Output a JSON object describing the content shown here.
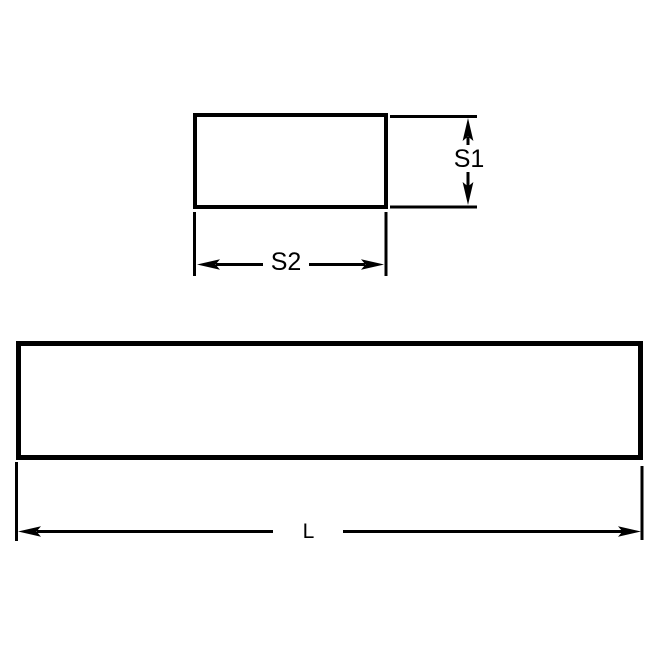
{
  "drawing": {
    "background_color": "#ffffff",
    "line_color": "#000000",
    "labels": {
      "s1": "S1",
      "s2": "S2",
      "length": "L"
    }
  }
}
